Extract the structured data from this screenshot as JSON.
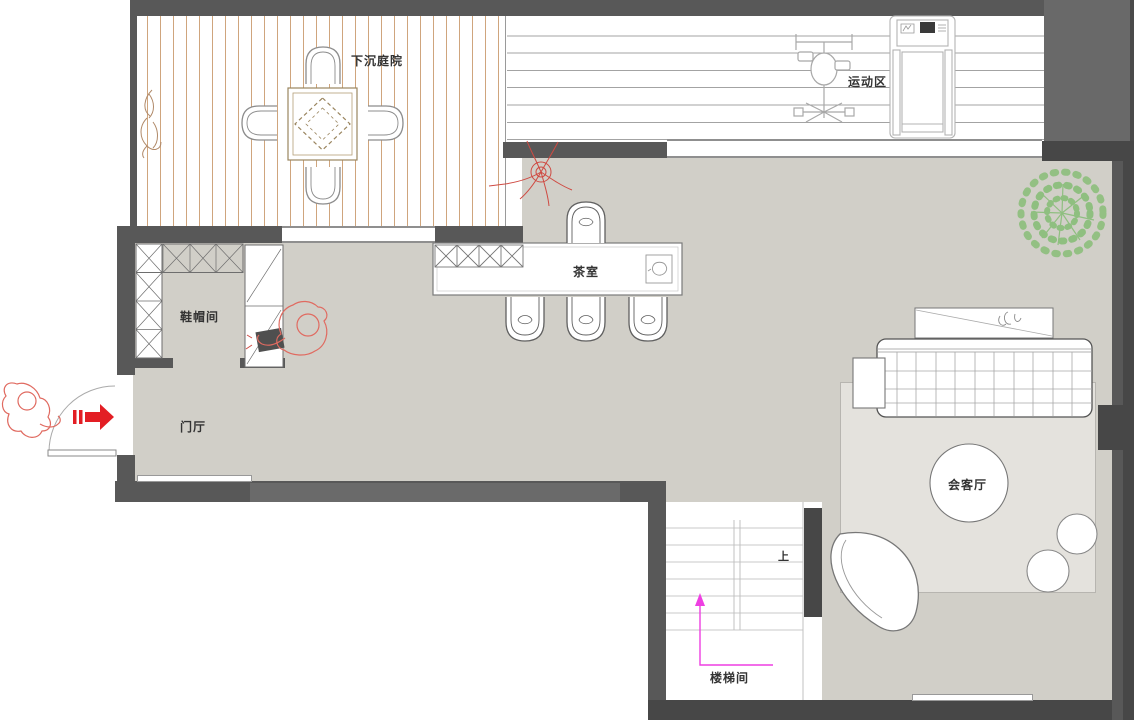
{
  "rooms": {
    "courtyard": {
      "label": "下沉庭院"
    },
    "exercise": {
      "label": "运动区"
    },
    "tea": {
      "label": "茶室"
    },
    "cloakroom": {
      "label": "鞋帽间"
    },
    "hall": {
      "label": "门厅"
    },
    "stairwell": {
      "label": "楼梯间"
    },
    "reception": {
      "label": "会客厅"
    }
  },
  "stairs": {
    "direction_label": "上"
  },
  "palette": {
    "wall": "#585858",
    "wall_dark": "#474747",
    "floor": "#d1cfc8",
    "rug": "#e4e2dd",
    "deck_plank_line": "#cfa57d",
    "sketch_red": "#d94a44",
    "entry_arrow_red": "#e31e24",
    "stair_arrow_magenta": "#ee3fe2",
    "plant_green": "#8fbf80"
  },
  "furniture_icons": [
    "outdoor-table",
    "outdoor-chairs",
    "garden-plant",
    "exercise-bike",
    "treadmill",
    "tea-table",
    "display-shelf",
    "tea-chairs",
    "teapot",
    "wardrobe-cabinet",
    "shoe-bench",
    "entry-door",
    "entry-arrow",
    "person-sketch",
    "sofa",
    "console-table",
    "side-table",
    "round-table",
    "pouf",
    "lounge-chair",
    "rug",
    "tree",
    "stairs"
  ]
}
